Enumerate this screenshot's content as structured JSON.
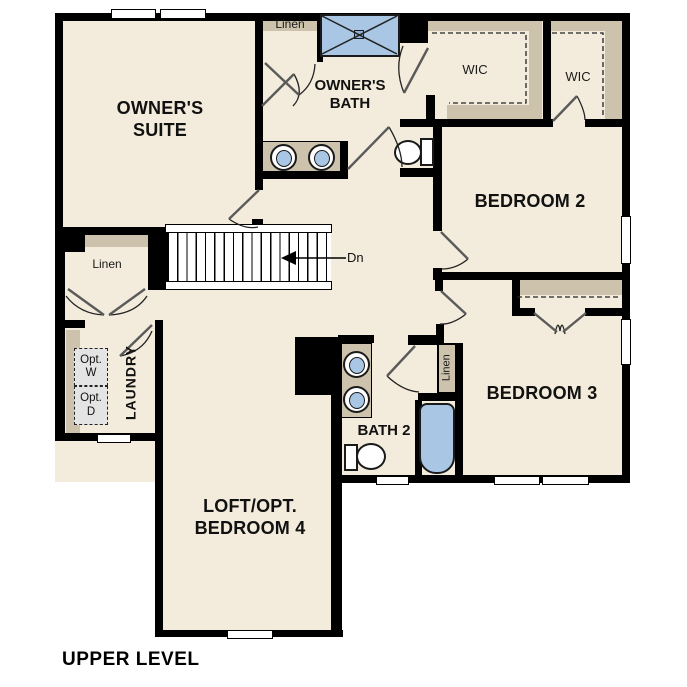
{
  "title": "UPPER LEVEL",
  "colors": {
    "floor": "#f3ecdc",
    "shelf": "#cdc3ac",
    "fixture": "#a9c7e4",
    "wall": "#000000",
    "appliance_fill": "#e4e4e4",
    "outside": "#ffffff"
  },
  "rooms": {
    "owners_suite": "OWNER'S\nSUITE",
    "owners_bath": "OWNER'S\nBATH",
    "wic1": "WIC",
    "wic2": "WIC",
    "bedroom2": "BEDROOM 2",
    "bedroom3": "BEDROOM 3",
    "bath2": "BATH 2",
    "laundry": "LAUNDRY",
    "loft": "LOFT/OPT.\nBEDROOM 4"
  },
  "closets": {
    "linen_top": "Linen",
    "linen_hall": "Linen",
    "linen_bath2": "Linen"
  },
  "appliances": {
    "opt_washer": "Opt.\nW",
    "opt_dryer": "Opt.\nD"
  },
  "stairs": {
    "down_label": "Dn"
  }
}
